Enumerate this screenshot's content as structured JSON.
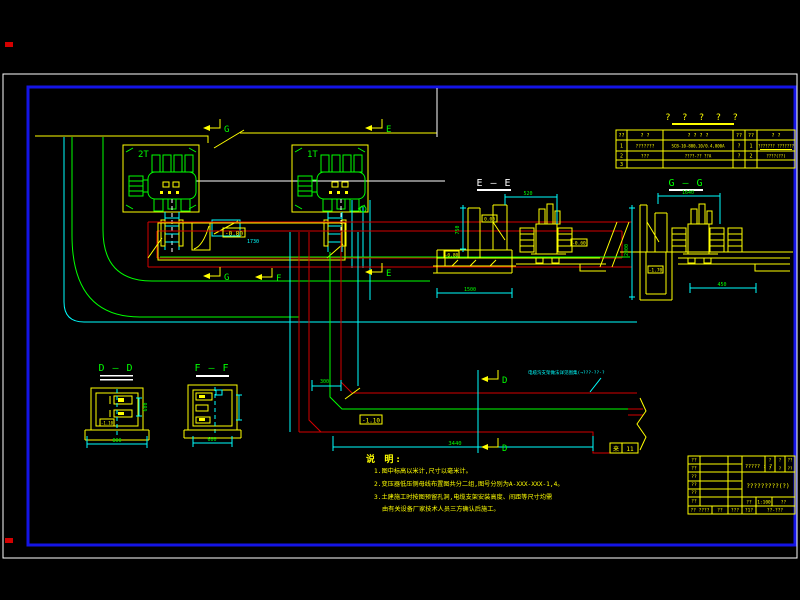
{
  "colors": {
    "background": "#000000",
    "frame": "#ffffff",
    "border_blue": "#1414e6",
    "cad_yellow": "#ffff00",
    "cad_green": "#00ff00",
    "cad_red": "#d40000",
    "cad_cyan": "#00ffff"
  },
  "plan": {
    "transformer_2_label": "2T",
    "transformer_1_label": "1T",
    "marker_g": "G",
    "marker_e": "E",
    "marker_f": "F",
    "marker_d": "D",
    "elev_upper_trench": "-0.80",
    "elev_lower_trench": "-1.10",
    "elev_small": "-0.60",
    "dim_300": "300",
    "dim_3440": "3440",
    "dim_1730": "1730",
    "cable_note": "电缆沟支架做法详见图集(→???-??-?",
    "stamp_left": "来",
    "stamp_right": "11"
  },
  "sections": {
    "ee": {
      "title": "E — E",
      "dim_top": "520",
      "dim_left": "750",
      "dim_bottom": "1500",
      "elev_top": "0.00",
      "elev_bottom": "-0.80"
    },
    "gg": {
      "title": "G — G",
      "dim_top": "1640",
      "dim_left": "2000",
      "dim_bottom": "450",
      "elev_pit": "-1.70"
    },
    "dd": {
      "title": "D — D",
      "dim_right": "600",
      "dim_bottom": "800",
      "elev": "-1.10"
    },
    "ff": {
      "title": "F — F",
      "dim_bottom": "600"
    }
  },
  "parts_table": {
    "title": "? ? ? ? ?",
    "headers": [
      "??",
      "?  ?",
      "?  ?  ?  ?",
      "??",
      "??",
      "?  ?"
    ],
    "rows": [
      [
        "1",
        "???????",
        "SCB-10-800,10/0.4,800A",
        "?",
        "1",
        "??????? ???????"
      ],
      [
        "2",
        "???",
        "????-?? ??A",
        "?",
        "2",
        "????(??)"
      ],
      [
        "3",
        "",
        "",
        "",
        "",
        ""
      ]
    ]
  },
  "notes": {
    "heading": "说 明:",
    "items": [
      "1.图中标高以米计,尺寸以毫米计。",
      "2.变压器低压侧母线布置图共分二组,图号分别为A-XXX-XXX-1,4。",
      "3.土建施工时按图预留孔洞,电缆支架安装高度、间距等尺寸均需",
      "由有关设备厂家技术人员三方确认后施工。"
    ]
  },
  "title_block": {
    "left_labels": [
      "??",
      "??",
      "??",
      "??",
      "??",
      "??"
    ],
    "project": "????? : ?",
    "grid_cells": [
      "?",
      "?",
      "??",
      "?",
      "?",
      "??"
    ],
    "drawing_title": "?????????(?)",
    "row3": [
      "??",
      "1:100",
      "??"
    ],
    "row4": [
      "?? ????",
      "??",
      "???",
      "?1?",
      "??-???"
    ]
  }
}
